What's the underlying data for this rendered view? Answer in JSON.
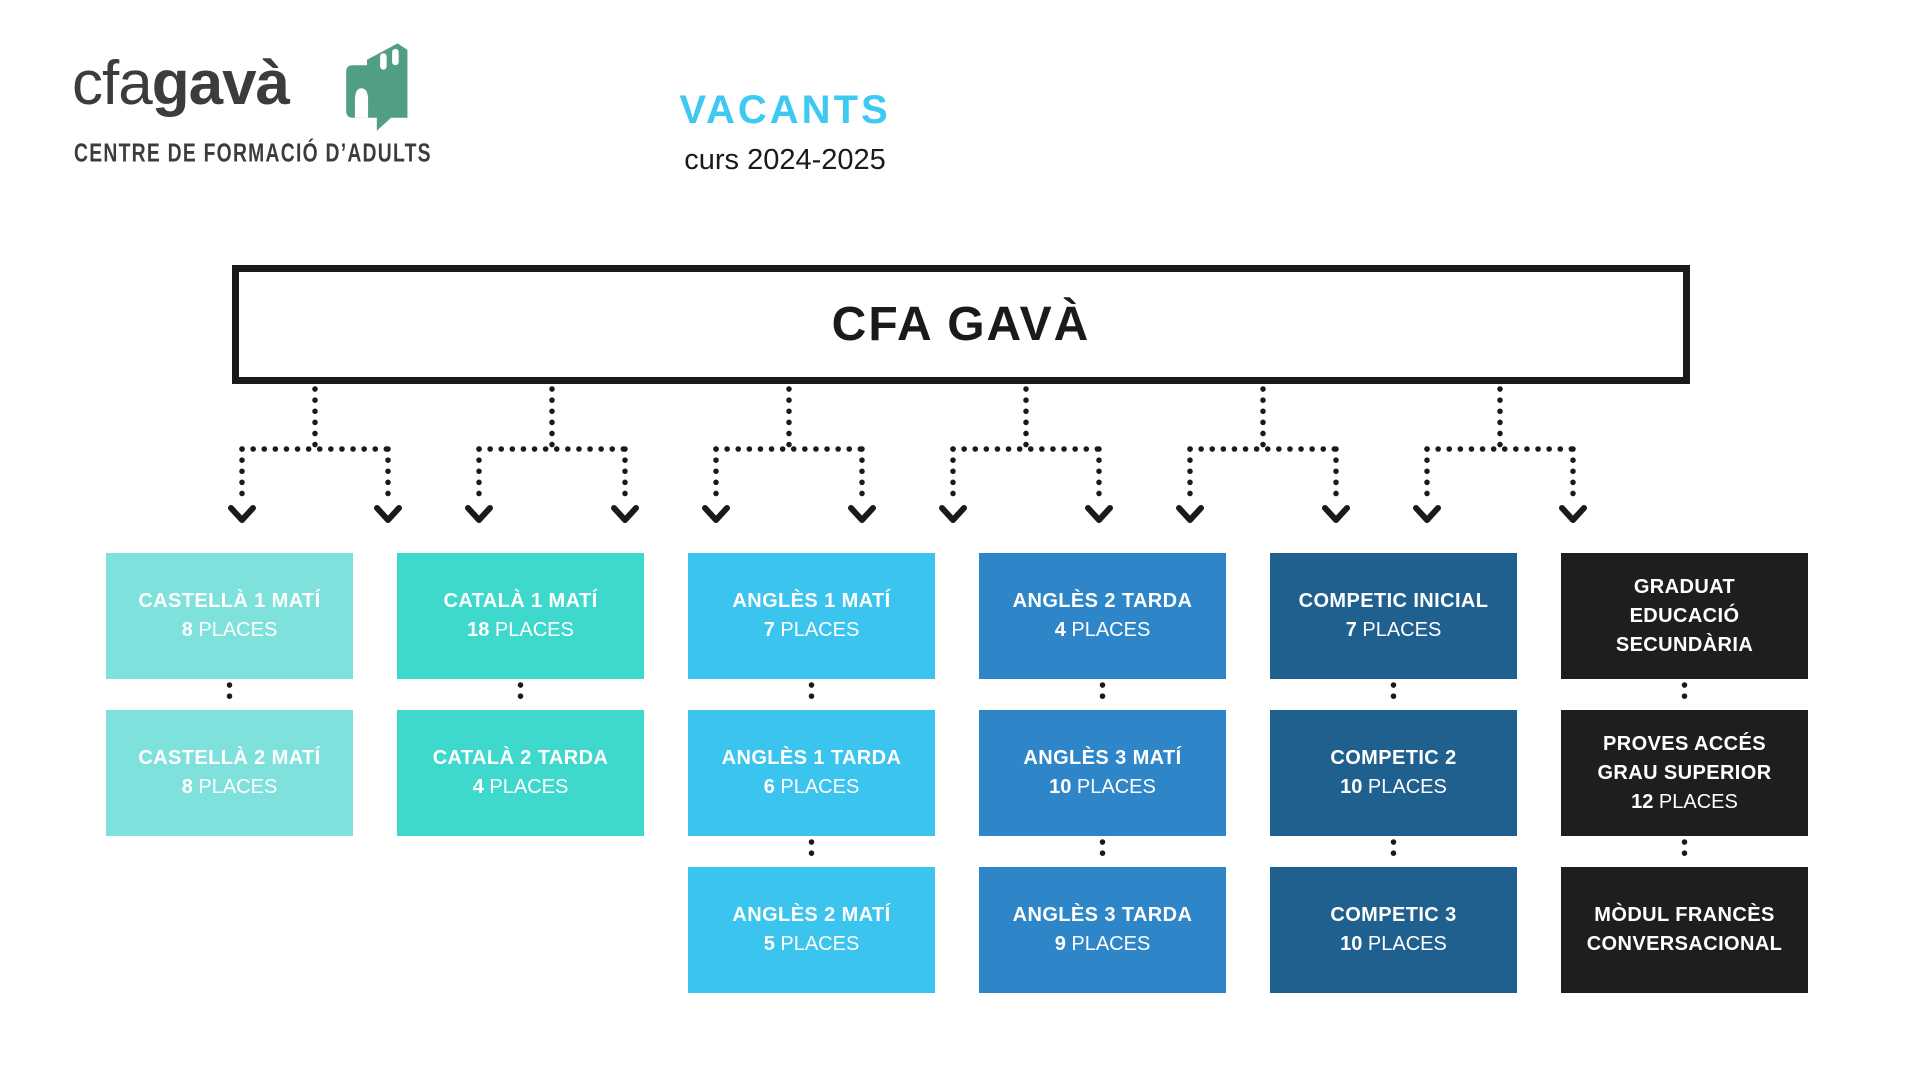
{
  "logo": {
    "brand_light": "cfa",
    "brand_bold": "gavà",
    "tagline": "CENTRE DE FORMACIÓ D’ADULTS",
    "icon": "school-building-speech-bubble-icon"
  },
  "header": {
    "title": "VACANTS",
    "subtitle": "curs 2024-2025"
  },
  "root_box": {
    "label": "CFA GAVÀ"
  },
  "colors": {
    "accent_cyan": "#3ec9f2",
    "logo_green": "#519e84",
    "ink": "#1a1a1a",
    "logo_text": "#3c3c3c",
    "col_castella": "#7ee1dc",
    "col_catala": "#3fd8cc",
    "col_angles_mati": "#3ac4ee",
    "col_angles_tarda": "#2e86c8",
    "col_competic": "#20608f",
    "col_graduat": "#1e1e1e"
  },
  "places_word": "PLACES",
  "columns": [
    {
      "name": "castella",
      "color": "#7ee1dc",
      "boxes": [
        {
          "title_lines": [
            "CASTELLÀ 1 MATÍ"
          ],
          "places": "8",
          "places_word": "PLACES"
        },
        {
          "title_lines": [
            "CASTELLÀ 2 MATÍ"
          ],
          "places": "8",
          "places_word": "PLACES"
        }
      ]
    },
    {
      "name": "catala",
      "color": "#3fd8cc",
      "boxes": [
        {
          "title_lines": [
            "CATALÀ 1 MATÍ"
          ],
          "places": "18",
          "places_word": "PLACES"
        },
        {
          "title_lines": [
            "CATALÀ 2 TARDA"
          ],
          "places": "4",
          "places_word": "PLACES"
        }
      ]
    },
    {
      "name": "angles-mati",
      "color": "#3ac4ee",
      "boxes": [
        {
          "title_lines": [
            "ANGLÈS 1 MATÍ"
          ],
          "places": "7",
          "places_word": "PLACES"
        },
        {
          "title_lines": [
            "ANGLÈS 1 TARDA"
          ],
          "places": "6",
          "places_word": "PLACES"
        },
        {
          "title_lines": [
            "ANGLÈS 2 MATÍ"
          ],
          "places": "5",
          "places_word": "PLACES"
        }
      ]
    },
    {
      "name": "angles-tarda",
      "color": "#2e86c8",
      "boxes": [
        {
          "title_lines": [
            "ANGLÈS 2 TARDA"
          ],
          "places": "4",
          "places_word": "PLACES"
        },
        {
          "title_lines": [
            "ANGLÈS 3 MATÍ"
          ],
          "places": "10",
          "places_word": "PLACES"
        },
        {
          "title_lines": [
            "ANGLÈS 3 TARDA"
          ],
          "places": "9",
          "places_word": "PLACES"
        }
      ]
    },
    {
      "name": "competic",
      "color": "#20608f",
      "boxes": [
        {
          "title_lines": [
            "COMPETIC INICIAL"
          ],
          "places": "7",
          "places_word": "PLACES"
        },
        {
          "title_lines": [
            "COMPETIC 2"
          ],
          "places": "10",
          "places_word": "PLACES"
        },
        {
          "title_lines": [
            "COMPETIC 3"
          ],
          "places": "10",
          "places_word": "PLACES"
        }
      ]
    },
    {
      "name": "graduat",
      "color": "#1e1e1e",
      "boxes": [
        {
          "title_lines": [
            "GRADUAT",
            "EDUCACIÓ",
            "SECUNDÀRIA"
          ]
        },
        {
          "title_lines": [
            "PROVES ACCÉS",
            "GRAU SUPERIOR"
          ],
          "places": "12",
          "places_word": "PLACES"
        },
        {
          "title_lines": [
            "MÒDUL FRANCÈS",
            "CONVERSACIONAL"
          ]
        }
      ]
    }
  ]
}
